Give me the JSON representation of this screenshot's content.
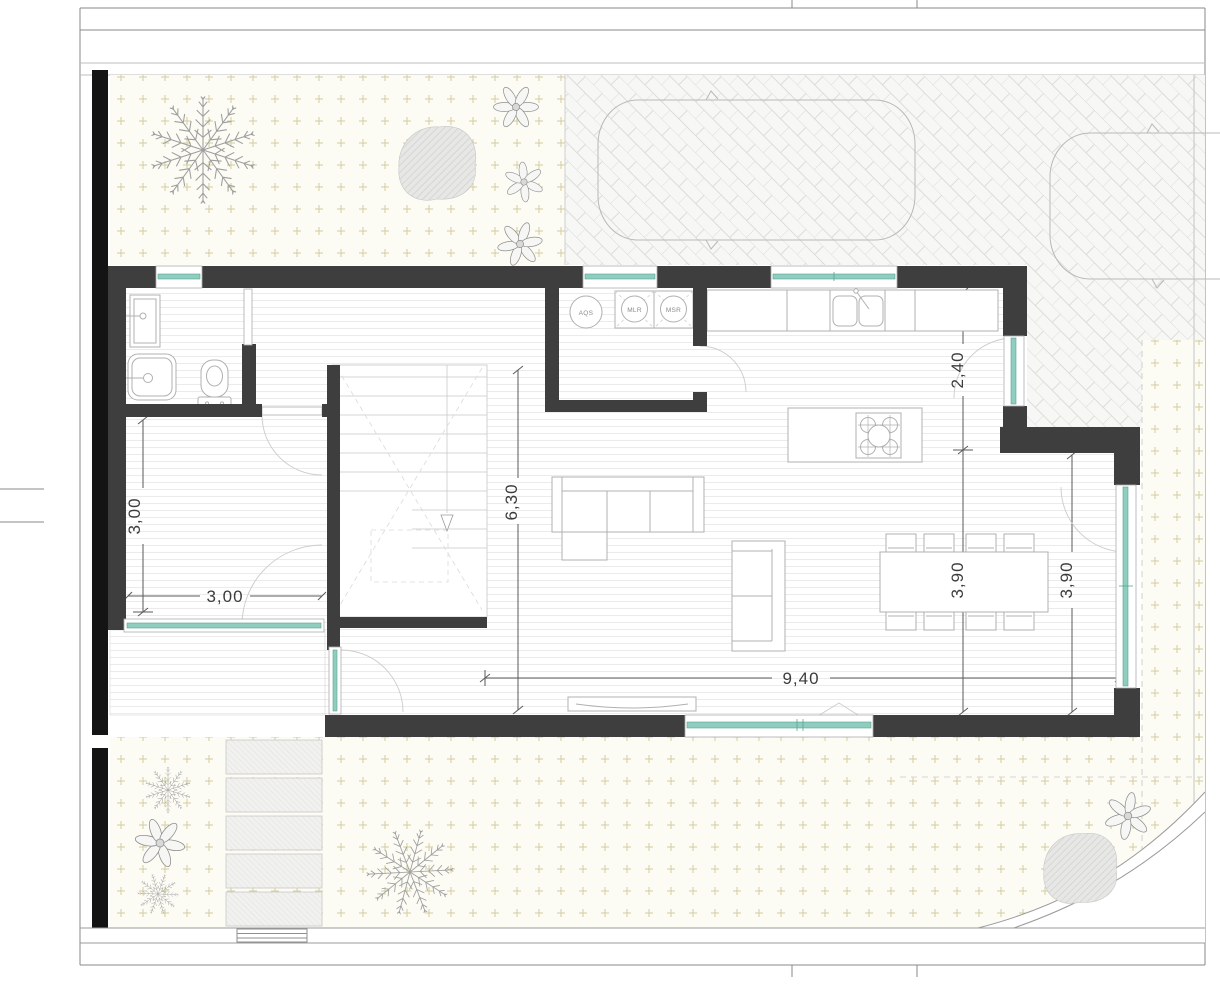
{
  "floor_plan": {
    "laundry_labels": {
      "water_heater": "AQS",
      "washer": "MLR",
      "dryer": "MSR"
    },
    "dimensions": {
      "room_width": "3,00",
      "room_depth": "3,00",
      "hall_depth": "6,30",
      "living_length": "9,40",
      "kitchen_depth": "2,40",
      "living_depth": "3,90",
      "window_span": "3,90"
    },
    "colors": {
      "wall": "#3e3e3e",
      "site_wall": "#141414",
      "glazing": "#8fcdbf",
      "glazing_edge": "#5aa394",
      "garden_dots": "#d5cd9f",
      "paving_lines": "#dcdcda",
      "floor_stripes": "#ebebeb",
      "furniture_stroke": "#b0b0b0",
      "dimension_text": "#3c3c3c"
    }
  }
}
